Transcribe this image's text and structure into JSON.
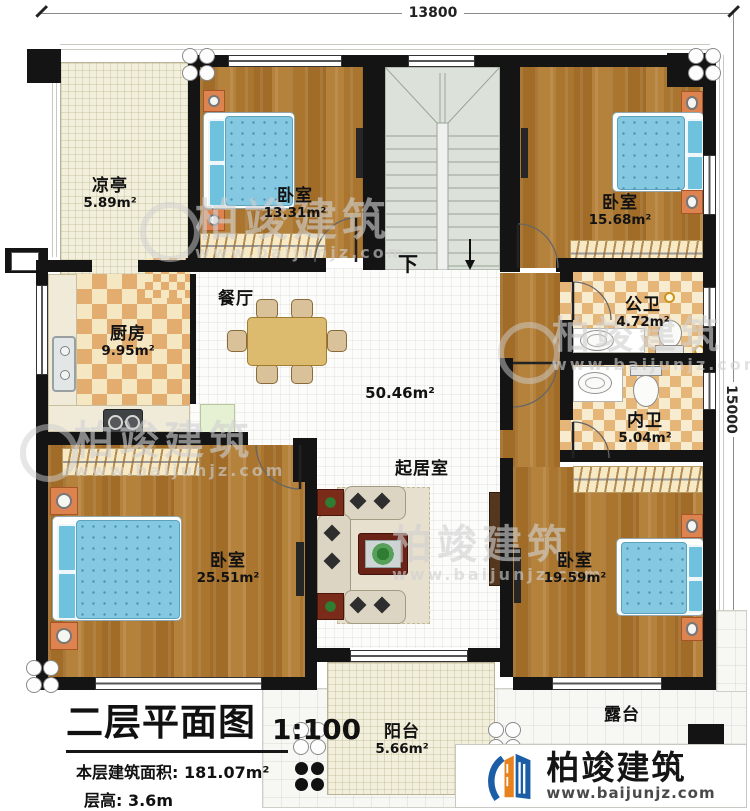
{
  "title_block": {
    "plan_name": "二层平面图",
    "scale": "1:100",
    "area_line": "本层建筑面积: 181.07m²",
    "height_line": "层高: 3.6m"
  },
  "dimensions": {
    "top": "13800",
    "right": "15000"
  },
  "stairs": {
    "down": "下"
  },
  "rooms": {
    "pavilion": {
      "name": "凉亭",
      "area": "5.89m²"
    },
    "bedroom_a": {
      "name": "卧室",
      "area": "13.31m²"
    },
    "bedroom_b": {
      "name": "卧室",
      "area": "15.68m²"
    },
    "kitchen": {
      "name": "厨房",
      "area": "9.95m²"
    },
    "dining": {
      "name": "餐厅"
    },
    "public_bath": {
      "name": "公卫",
      "area": "4.72m²"
    },
    "private_bath": {
      "name": "内卫",
      "area": "5.04m²"
    },
    "living": {
      "name": "起居室",
      "area": "50.46m²"
    },
    "bedroom_c": {
      "name": "卧室",
      "area": "25.51m²"
    },
    "bedroom_d": {
      "name": "卧室",
      "area": "19.59m²"
    },
    "balcony": {
      "name": "阳台",
      "area": "5.66m²"
    },
    "terrace": {
      "name": "露台"
    }
  },
  "watermark": {
    "brand": "柏竣建筑",
    "url": "www.baijunjz.com"
  },
  "logo": {
    "brand": "柏竣建筑",
    "url": "www.baijunjz.com"
  },
  "colors": {
    "wall": "#141414",
    "wood": "#ab7731",
    "accent_blue": "#1b5ea6",
    "accent_orange": "#e8821e",
    "bed_blue": "#84c8e1"
  }
}
